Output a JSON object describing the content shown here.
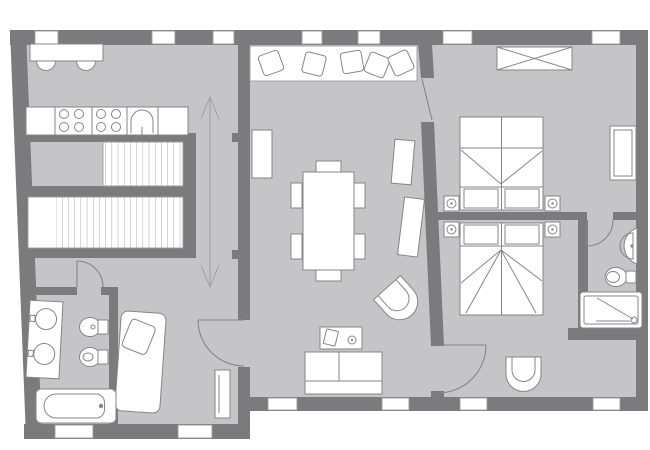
{
  "plan_type": "apartment-floor-plan",
  "colors": {
    "background": "#ffffff",
    "wall": "#7b7b7e",
    "floor": "#c5c5c7",
    "fixture": "#ffffff",
    "outline": "#85858a",
    "detail": "#9c9c9f"
  },
  "counts": {
    "windows": 13,
    "doors": 5,
    "stair_flights": 2
  },
  "rooms": [
    {
      "name": "kitchen",
      "furniture": [
        "breakfast-table",
        "stool",
        "stool",
        "kitchen-counter",
        "cooktop-burners",
        "cooktop-burners",
        "kitchen-sink"
      ]
    },
    {
      "name": "stairwell",
      "furniture": [
        "upper-stair-flight",
        "lower-stair-flight",
        "direction-arrow"
      ]
    },
    {
      "name": "hallway",
      "furniture": []
    },
    {
      "name": "balcony",
      "furniture": [
        "lounge-chair",
        "lounge-chair",
        "lounge-chair",
        "lounge-chair",
        "lounge-chair"
      ]
    },
    {
      "name": "living-dining-room",
      "furniture": [
        "dining-table",
        "dining-chair x6",
        "sofa",
        "coffee-table",
        "armchair",
        "radiator",
        "radiator",
        "radiator"
      ]
    },
    {
      "name": "bedroom-1",
      "furniture": [
        "wardrobe",
        "double-bed",
        "nightstand-lamp",
        "nightstand-lamp",
        "radiator"
      ]
    },
    {
      "name": "bedroom-2",
      "furniture": [
        "double-bed",
        "nightstand-lamp",
        "nightstand-lamp",
        "armchair"
      ]
    },
    {
      "name": "bathroom-1",
      "furniture": [
        "double-washbasin-vanity",
        "toilet",
        "bidet",
        "bathtub"
      ]
    },
    {
      "name": "bathroom-2",
      "furniture": [
        "washbasin",
        "toilet",
        "shower-tray"
      ]
    },
    {
      "name": "single-bedroom",
      "furniture": [
        "single-bed",
        "radiator"
      ]
    }
  ]
}
